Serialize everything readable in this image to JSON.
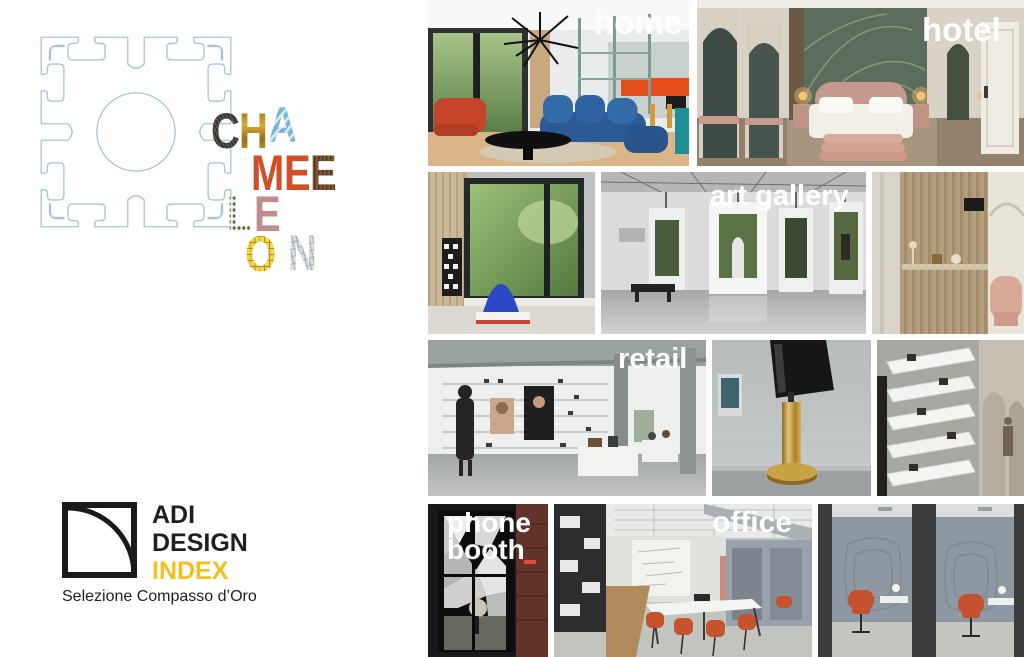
{
  "page": {
    "background": "#ffffff"
  },
  "wordmark": {
    "word": "CHAMELEON",
    "letters": [
      {
        "char": "C",
        "texture": "dark-carbon-fabric",
        "color": "#413d36"
      },
      {
        "char": "H",
        "texture": "gold-metal",
        "color": "#a8821e"
      },
      {
        "char": "A",
        "texture": "light-blue-pattern",
        "color": "#8fc0da"
      },
      {
        "char": "M",
        "texture": "terracotta-orange",
        "color": "#d14f28"
      },
      {
        "char": "E",
        "texture": "terracotta-orange",
        "color": "#d14f28"
      },
      {
        "char": "E",
        "texture": "wood-grain",
        "color": "#6a4a2c"
      },
      {
        "char": "L",
        "texture": "polka-dot",
        "color": "#8a9070"
      },
      {
        "char": "E",
        "texture": "dusty-rose",
        "color": "#bf8e8c"
      },
      {
        "char": "O",
        "texture": "yellow-graph-grid",
        "color": "#e0d63c"
      },
      {
        "char": "N",
        "texture": "newsprint",
        "color": "#c9ced2"
      }
    ]
  },
  "profile_drawing": {
    "name": "t-slot-extrusion-profile",
    "line_color": "#a9c7d3"
  },
  "adi_logo": {
    "line1": "ADI",
    "line2": "DESIGN",
    "line3": "INDEX",
    "line3_color": "#f2c21c",
    "tagline": "Selezione Compasso d’Oro"
  },
  "collage": {
    "label_color": "#ffffff",
    "photos": [
      {
        "name": "home-living-room",
        "label": "home"
      },
      {
        "name": "hotel-bedroom",
        "label": "hotel"
      },
      {
        "name": "window-plant-room",
        "label": ""
      },
      {
        "name": "art-gallery",
        "label": "art gallery"
      },
      {
        "name": "wood-slat-shelving",
        "label": ""
      },
      {
        "name": "retail-store",
        "label": "retail"
      },
      {
        "name": "brass-leg-detail",
        "label": ""
      },
      {
        "name": "angled-display-shelves",
        "label": ""
      },
      {
        "name": "phone-booth",
        "label_line1": "phone",
        "label_line2": "booth"
      },
      {
        "name": "office-meeting-room",
        "label": "office"
      },
      {
        "name": "acoustic-work-booths",
        "label": ""
      }
    ]
  }
}
